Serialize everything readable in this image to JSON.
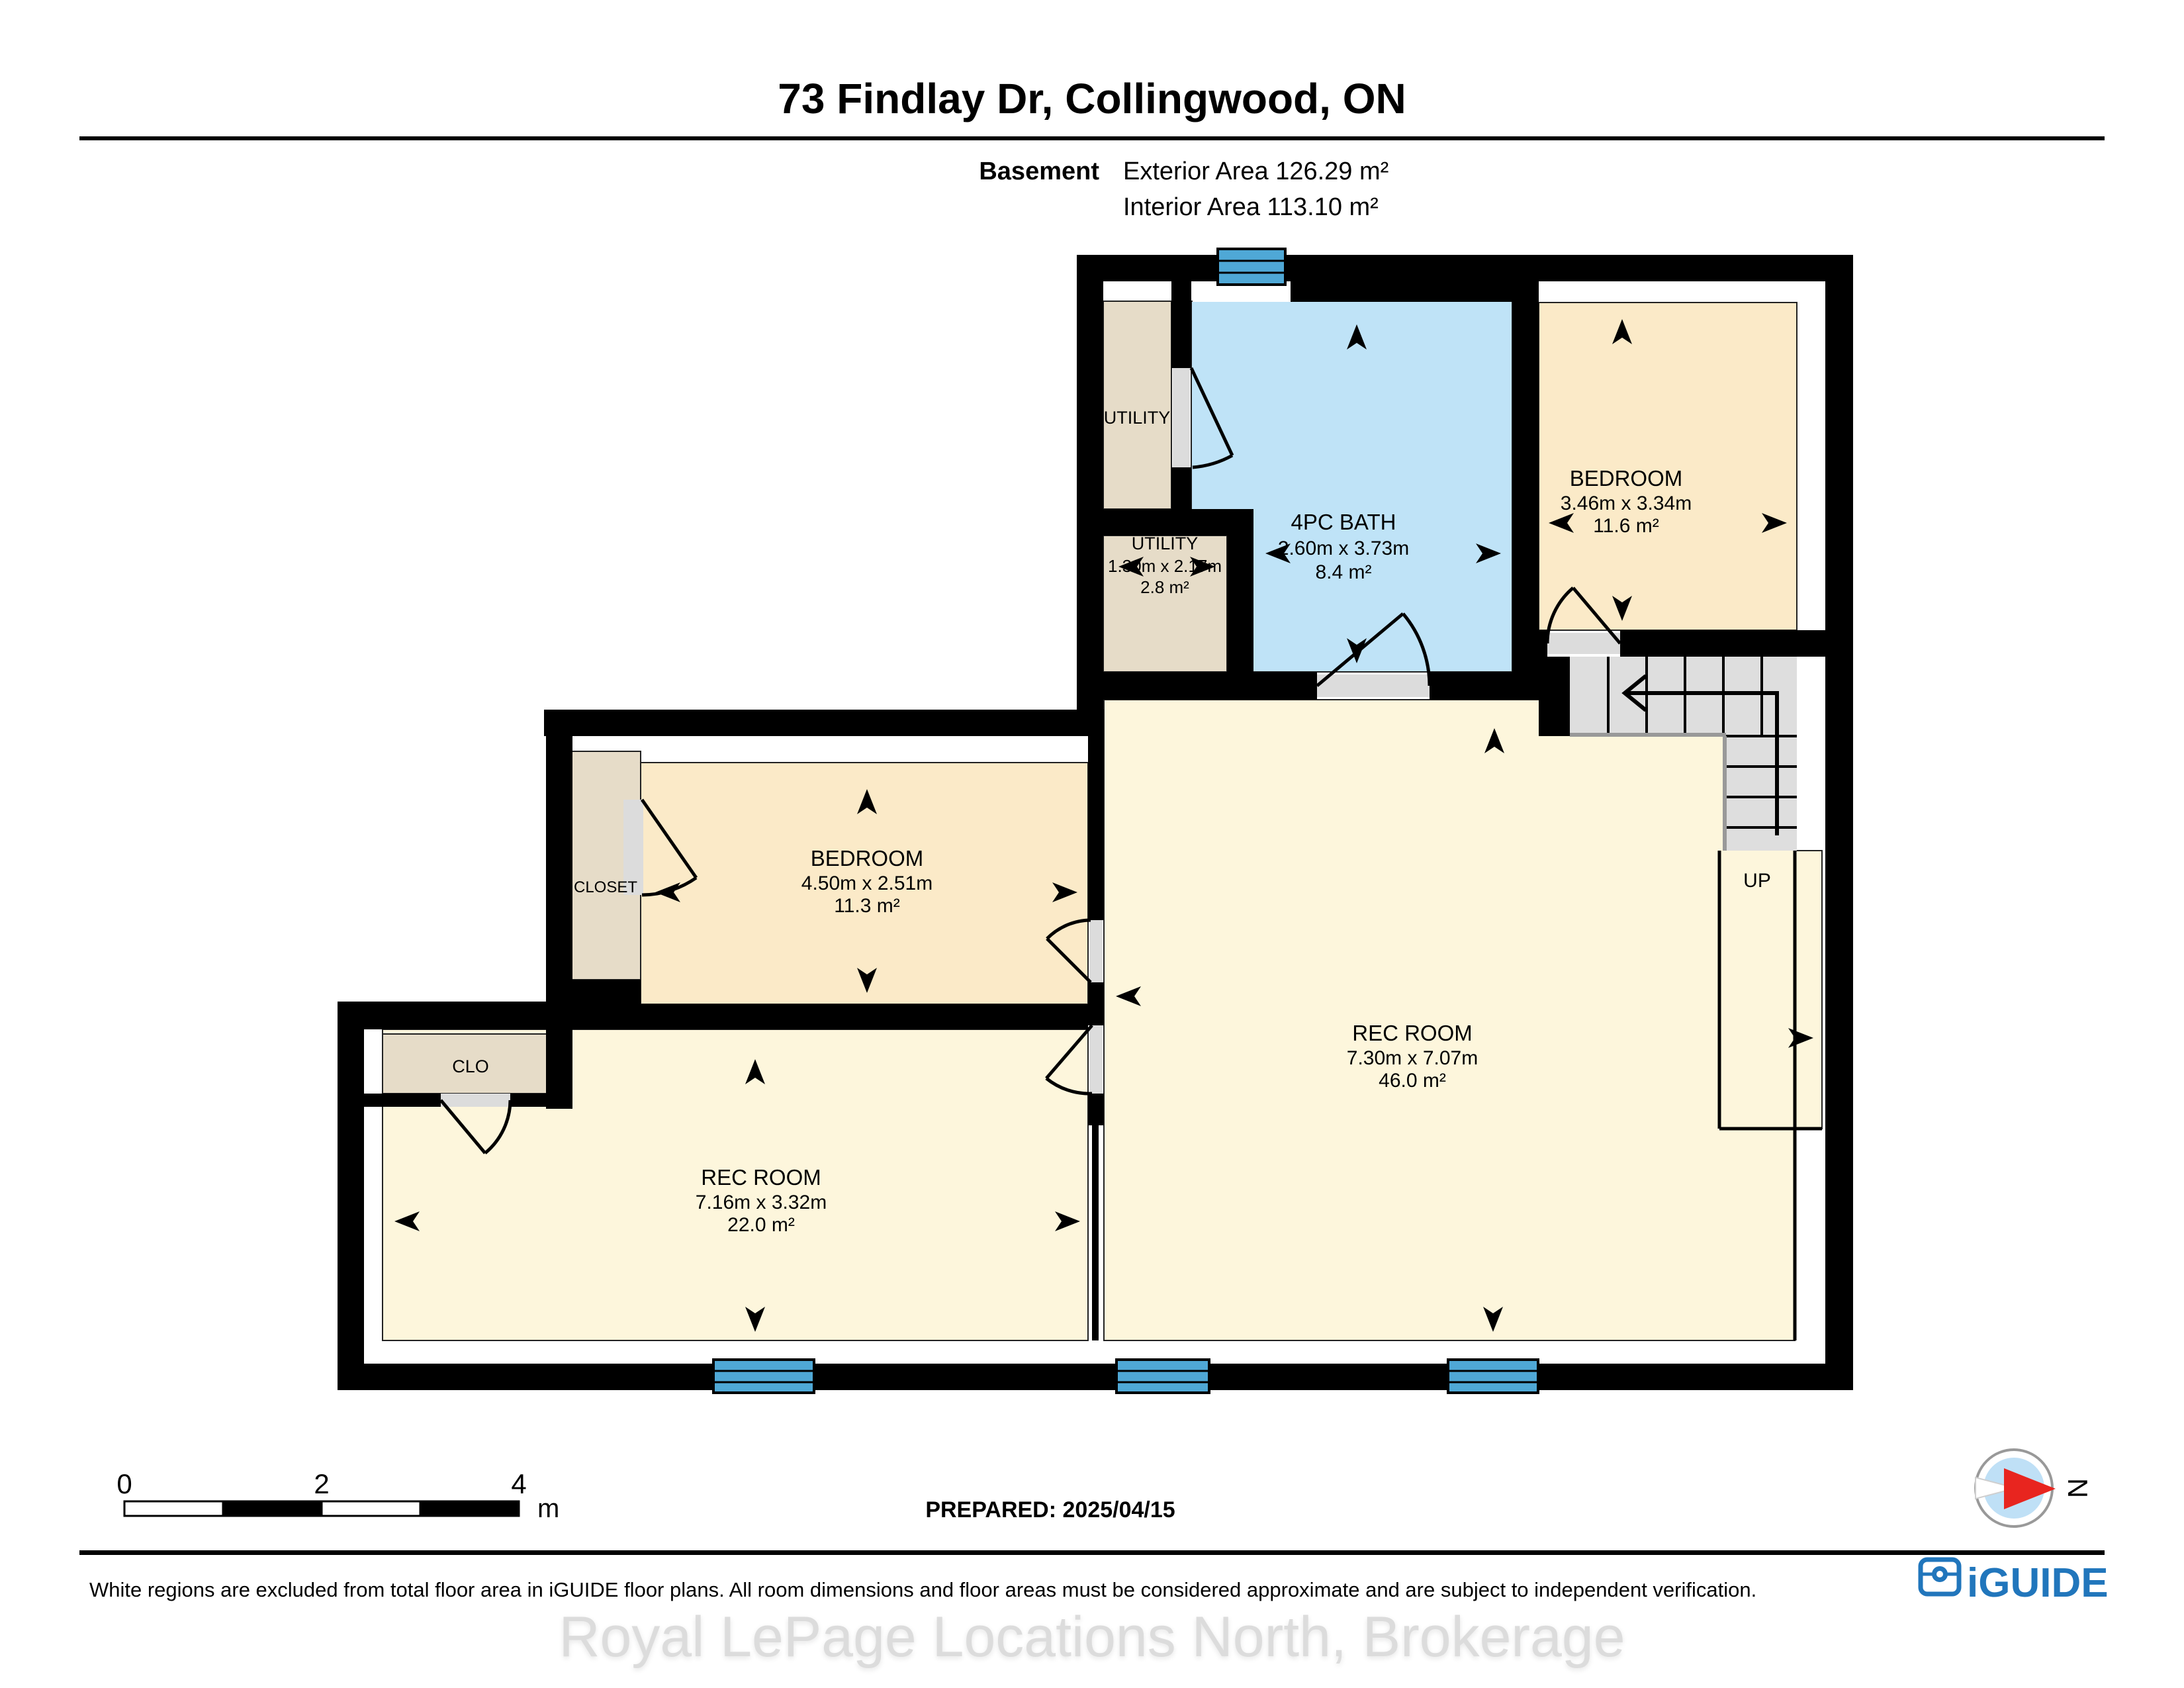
{
  "header": {
    "title": "73 Findlay Dr, Collingwood, ON",
    "floor_label": "Basement",
    "exterior_area": "Exterior Area 126.29 m²",
    "interior_area": "Interior Area 113.10 m²"
  },
  "rooms": {
    "utility_top": {
      "name": "UTILITY"
    },
    "bath": {
      "name": "4PC BATH",
      "dims": "2.60m x 3.73m",
      "area": "8.4 m²"
    },
    "bedroom_right": {
      "name": "BEDROOM",
      "dims": "3.46m x 3.34m",
      "area": "11.6 m²"
    },
    "utility_small": {
      "name": "UTILITY",
      "dims": "1.30m x 2.17m",
      "area": "2.8 m²"
    },
    "bedroom_mid": {
      "name": "BEDROOM",
      "dims": "4.50m x 2.51m",
      "area": "11.3 m²"
    },
    "closet": {
      "name": "CLOSET"
    },
    "clo": {
      "name": "CLO"
    },
    "rec_room_left": {
      "name": "REC ROOM",
      "dims": "7.16m x 3.32m",
      "area": "22.0 m²"
    },
    "rec_room_right": {
      "name": "REC ROOM",
      "dims": "7.30m x 7.07m",
      "area": "46.0 m²"
    },
    "stairs": {
      "label": "UP"
    }
  },
  "scale_bar": {
    "tick_0": "0",
    "tick_2": "2",
    "tick_4": "4",
    "unit": "m"
  },
  "prepared_label": "PREPARED: 2025/04/15",
  "compass": {
    "north_label": "N"
  },
  "footer": {
    "disclaimer": "White regions are excluded from total floor area in iGUIDE floor plans. All room dimensions and floor areas must be considered approximate and are subject to independent verification.",
    "watermark": "Royal LePage Locations North, Brokerage",
    "brand": "iGUIDE"
  },
  "colors": {
    "wall": "#000000",
    "rec_room_floor": "#FDF6DC",
    "bedroom_floor": "#FBEAC8",
    "utility_floor": "#E6DCC8",
    "bath_floor": "#BFE3F7",
    "window_blue": "#4FA8D6",
    "stairs_gray": "#DEDEDE",
    "brand_blue": "#2176BC",
    "compass_red": "#E8251F"
  }
}
